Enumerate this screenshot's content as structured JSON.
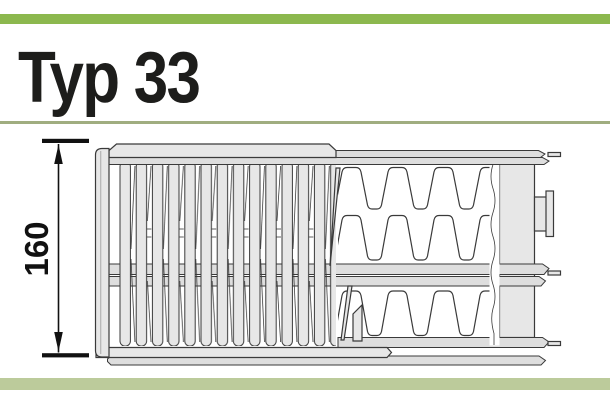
{
  "title": {
    "text": "Typ 33"
  },
  "diagram": {
    "dimension_label": "160"
  },
  "colors": {
    "green_bar": "#8cb84e",
    "divider": "#a0ad80",
    "bottom_bar": "#bccb9b",
    "ink": "#3a3a3a",
    "fill_light": "#e7e7e7",
    "fill_band": "#dedede",
    "text": "#1d1d1b",
    "dim": "#111111"
  }
}
